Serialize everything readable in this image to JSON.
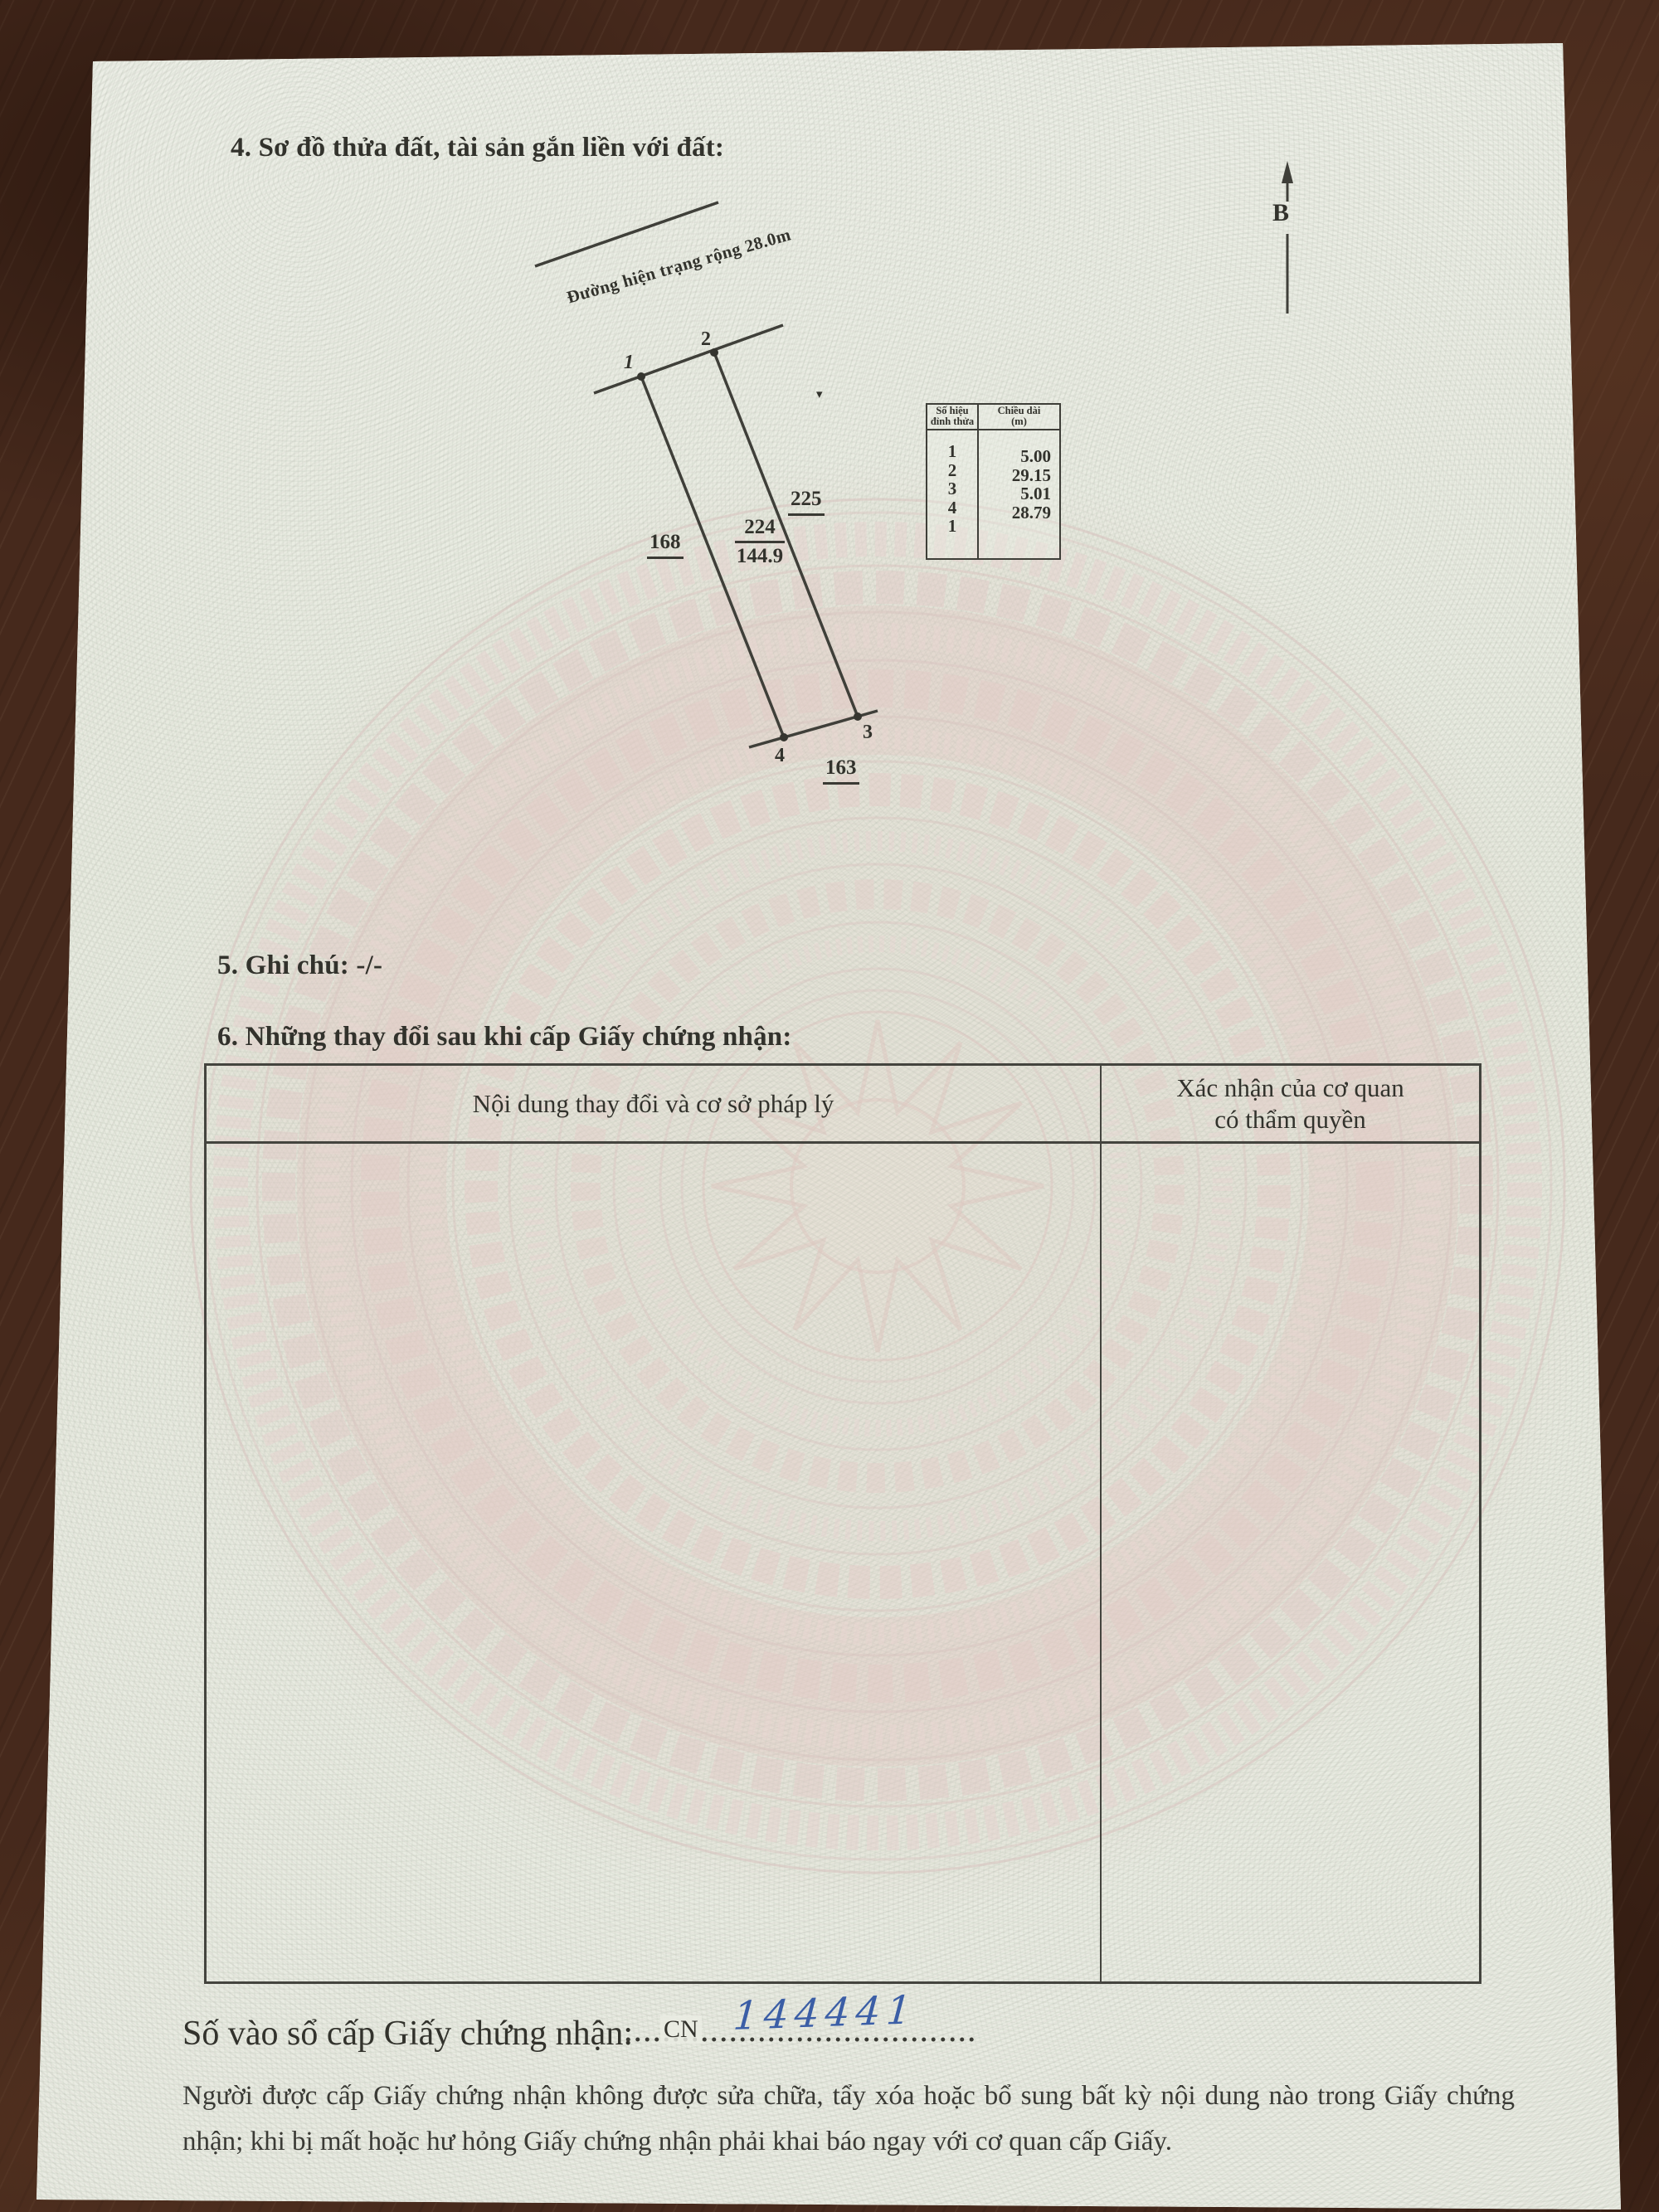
{
  "sections": {
    "s4_title": "4. Sơ đồ thửa đất, tài sản gắn liền với đất:",
    "s5_note": "5. Ghi chú: -/-",
    "s6_title": "6. Những thay đổi sau khi cấp Giấy chứng nhận:"
  },
  "diagram": {
    "road_label": "Đường hiện trạng rộng 28.0m",
    "compass_label": "B",
    "marker_glyph": "▾",
    "vertex_labels": [
      "1",
      "2",
      "3",
      "4"
    ],
    "adjacent_parcels": {
      "right": "225",
      "left": "168",
      "below": "163"
    },
    "parcel": {
      "number": "224",
      "area": "144.9"
    },
    "vertex_table": {
      "header_col1": [
        "Số hiệu",
        "đỉnh thửa"
      ],
      "header_col2": [
        "Chiều dài",
        "(m)"
      ],
      "vertices": [
        "1",
        "2",
        "3",
        "4",
        "1"
      ],
      "lengths": [
        "5.00",
        "29.15",
        "5.01",
        "28.79"
      ]
    }
  },
  "changes_table": {
    "col1_header": "Nội dung thay đổi và cơ sở pháp lý",
    "col2_header": [
      "Xác nhận của cơ quan",
      "có thẩm quyền"
    ]
  },
  "registry": {
    "label": "Số vào sổ cấp Giấy chứng nhận:",
    "prefix": "CN",
    "handwritten_number": "144441",
    "dots": "....................................."
  },
  "footer_note": "Người được cấp Giấy chứng nhận không được sửa chữa, tẩy xóa hoặc bổ sung bất kỳ nội dung nào trong Giấy chứng nhận; khi bị mất hoặc hư hỏng Giấy chứng nhận phải khai báo ngay với cơ quan cấp Giấy.",
  "colors": {
    "handwriting_blue": "#3b5ea6",
    "paper": "#eaece3",
    "wood": "#46291c",
    "ink": "#32322c",
    "watermark_pink": "#e3ccc7",
    "watermark_green": "#dde4da"
  }
}
